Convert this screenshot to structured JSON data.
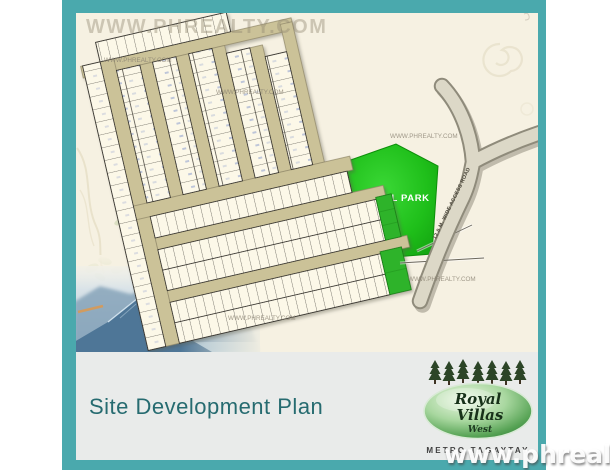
{
  "card": {
    "border_color": "#4aa9ad",
    "map_bg": "#f6f1e2",
    "footer_bg": "#e9ebea"
  },
  "map": {
    "central_park_label": "CENTRAL PARK",
    "access_road_label": "12.0 M. WIDE ACCESS ROAD",
    "park_color": "#1fbf1a",
    "road_color": "#cbc298",
    "lot_fill": "#fcf8e8"
  },
  "watermarks": {
    "top": "WWW.PHREALTY.COM",
    "small": "WWW.PHREALTY.COM",
    "corner": "www.phrealty.com"
  },
  "footer": {
    "title": "Site Development Plan",
    "title_color": "#266b70"
  },
  "logo": {
    "name_line1": "Royal",
    "name_line2": "Villas",
    "name_line3": "West",
    "subtitle": "METRO TAGAYTAY"
  }
}
